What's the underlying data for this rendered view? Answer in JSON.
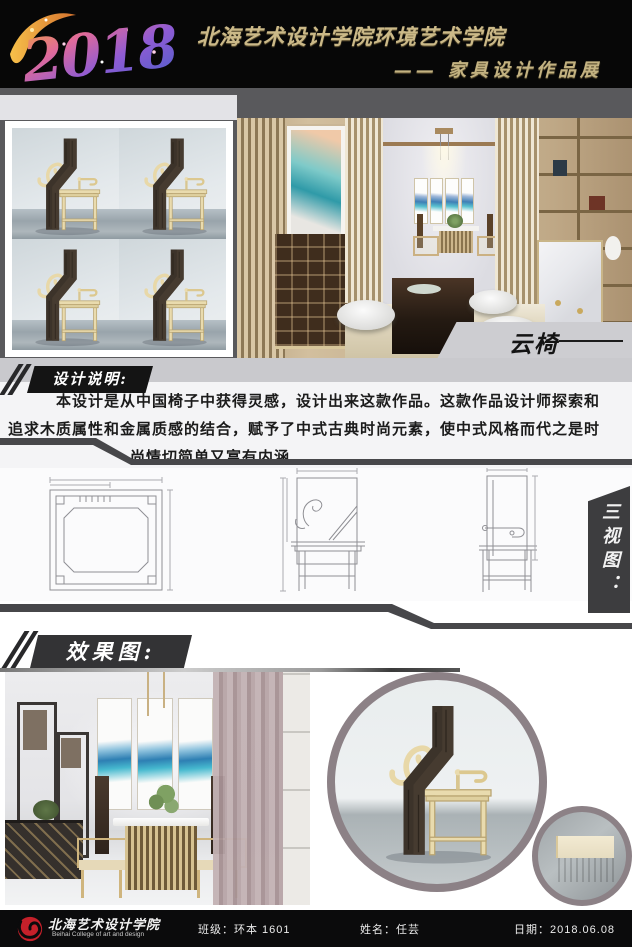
{
  "header": {
    "year": "2018",
    "school_title": "北海艺术设计学院环境艺术学院",
    "exhibition_subtitle": "—— 家具设计作品展"
  },
  "gallery": {
    "chair_label": "云椅"
  },
  "design_description": {
    "heading": "设计说明:",
    "line1": "本设计是从中国椅子中获得灵感，设计出来这款作品。这款作品设计师探索和",
    "line2": "追求木质属性和金属质感的结合，赋予了中式古典时尚元素，使中式风格而代之是时",
    "line3": "尚情切简单又富有内涵"
  },
  "orthographic_views": {
    "heading": "三视图："
  },
  "render_section": {
    "heading": "效果图:"
  },
  "footer": {
    "school_name": "北海艺术设计学院",
    "school_name_en": "Beihai College of art and design",
    "class_field": "班级：环本 1601",
    "name_field": "姓名：任芸",
    "date_field": "日期：2018.06.08"
  },
  "colors": {
    "header_bg": "#070707",
    "gold_text": "#cbb988",
    "backdrop_gray": "#59595c",
    "band_gray": "#c9c9cd",
    "divider_dark": "#47474a",
    "label_dark": "#333335",
    "ring_gray": "#8c8186",
    "logo_red": "#c5202a"
  }
}
